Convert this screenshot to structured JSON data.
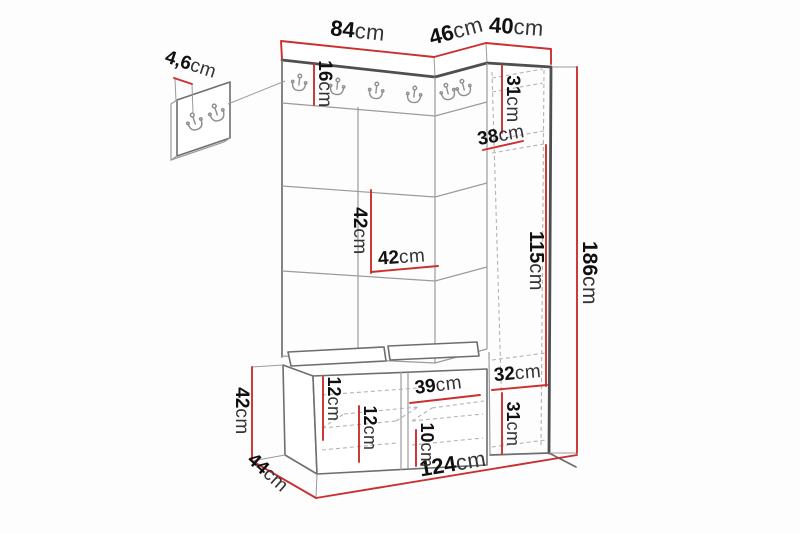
{
  "diagram": {
    "type": "furniture-dimension-diagram",
    "subject": "hallway set: wall hook panel with upholstered tiles, shoe bench and tall side cabinet",
    "unit": "cm",
    "colors": {
      "dimension_line": "#c9302f",
      "outline": "#4f4f4f",
      "detail_line": "#9b9b9b",
      "text": "#101010",
      "background": "#fdfdfd"
    },
    "icons": [
      "coat-hook-icon"
    ],
    "dims": {
      "panel_width": {
        "value": "84",
        "unit": "cm"
      },
      "corner_width": {
        "value": "46",
        "unit": "cm"
      },
      "cabinet_width": {
        "value": "40",
        "unit": "cm"
      },
      "hook_detail_width": {
        "value": "4,6",
        "unit": "cm"
      },
      "hook_rail_height": {
        "value": "16",
        "unit": "cm"
      },
      "cabinet_top_section": {
        "value": "31",
        "unit": "cm"
      },
      "cabinet_depth": {
        "value": "38",
        "unit": "cm"
      },
      "cabinet_middle_section": {
        "value": "115",
        "unit": "cm"
      },
      "total_height": {
        "value": "186",
        "unit": "cm"
      },
      "panel_tile_height": {
        "value": "42",
        "unit": "cm"
      },
      "panel_tile_width": {
        "value": "42",
        "unit": "cm"
      },
      "bench_height": {
        "value": "42",
        "unit": "cm"
      },
      "bench_depth": {
        "value": "44",
        "unit": "cm"
      },
      "total_width": {
        "value": "124",
        "unit": "cm"
      },
      "bench_top_clearance": {
        "value": "12",
        "unit": "cm"
      },
      "bench_shelf_clearance": {
        "value": "12",
        "unit": "cm"
      },
      "bench_compartment_width": {
        "value": "39",
        "unit": "cm"
      },
      "bench_bottom_clearance": {
        "value": "10",
        "unit": "cm"
      },
      "cabinet_shelf_width": {
        "value": "32",
        "unit": "cm"
      },
      "cabinet_bottom_section": {
        "value": "31",
        "unit": "cm"
      }
    }
  }
}
